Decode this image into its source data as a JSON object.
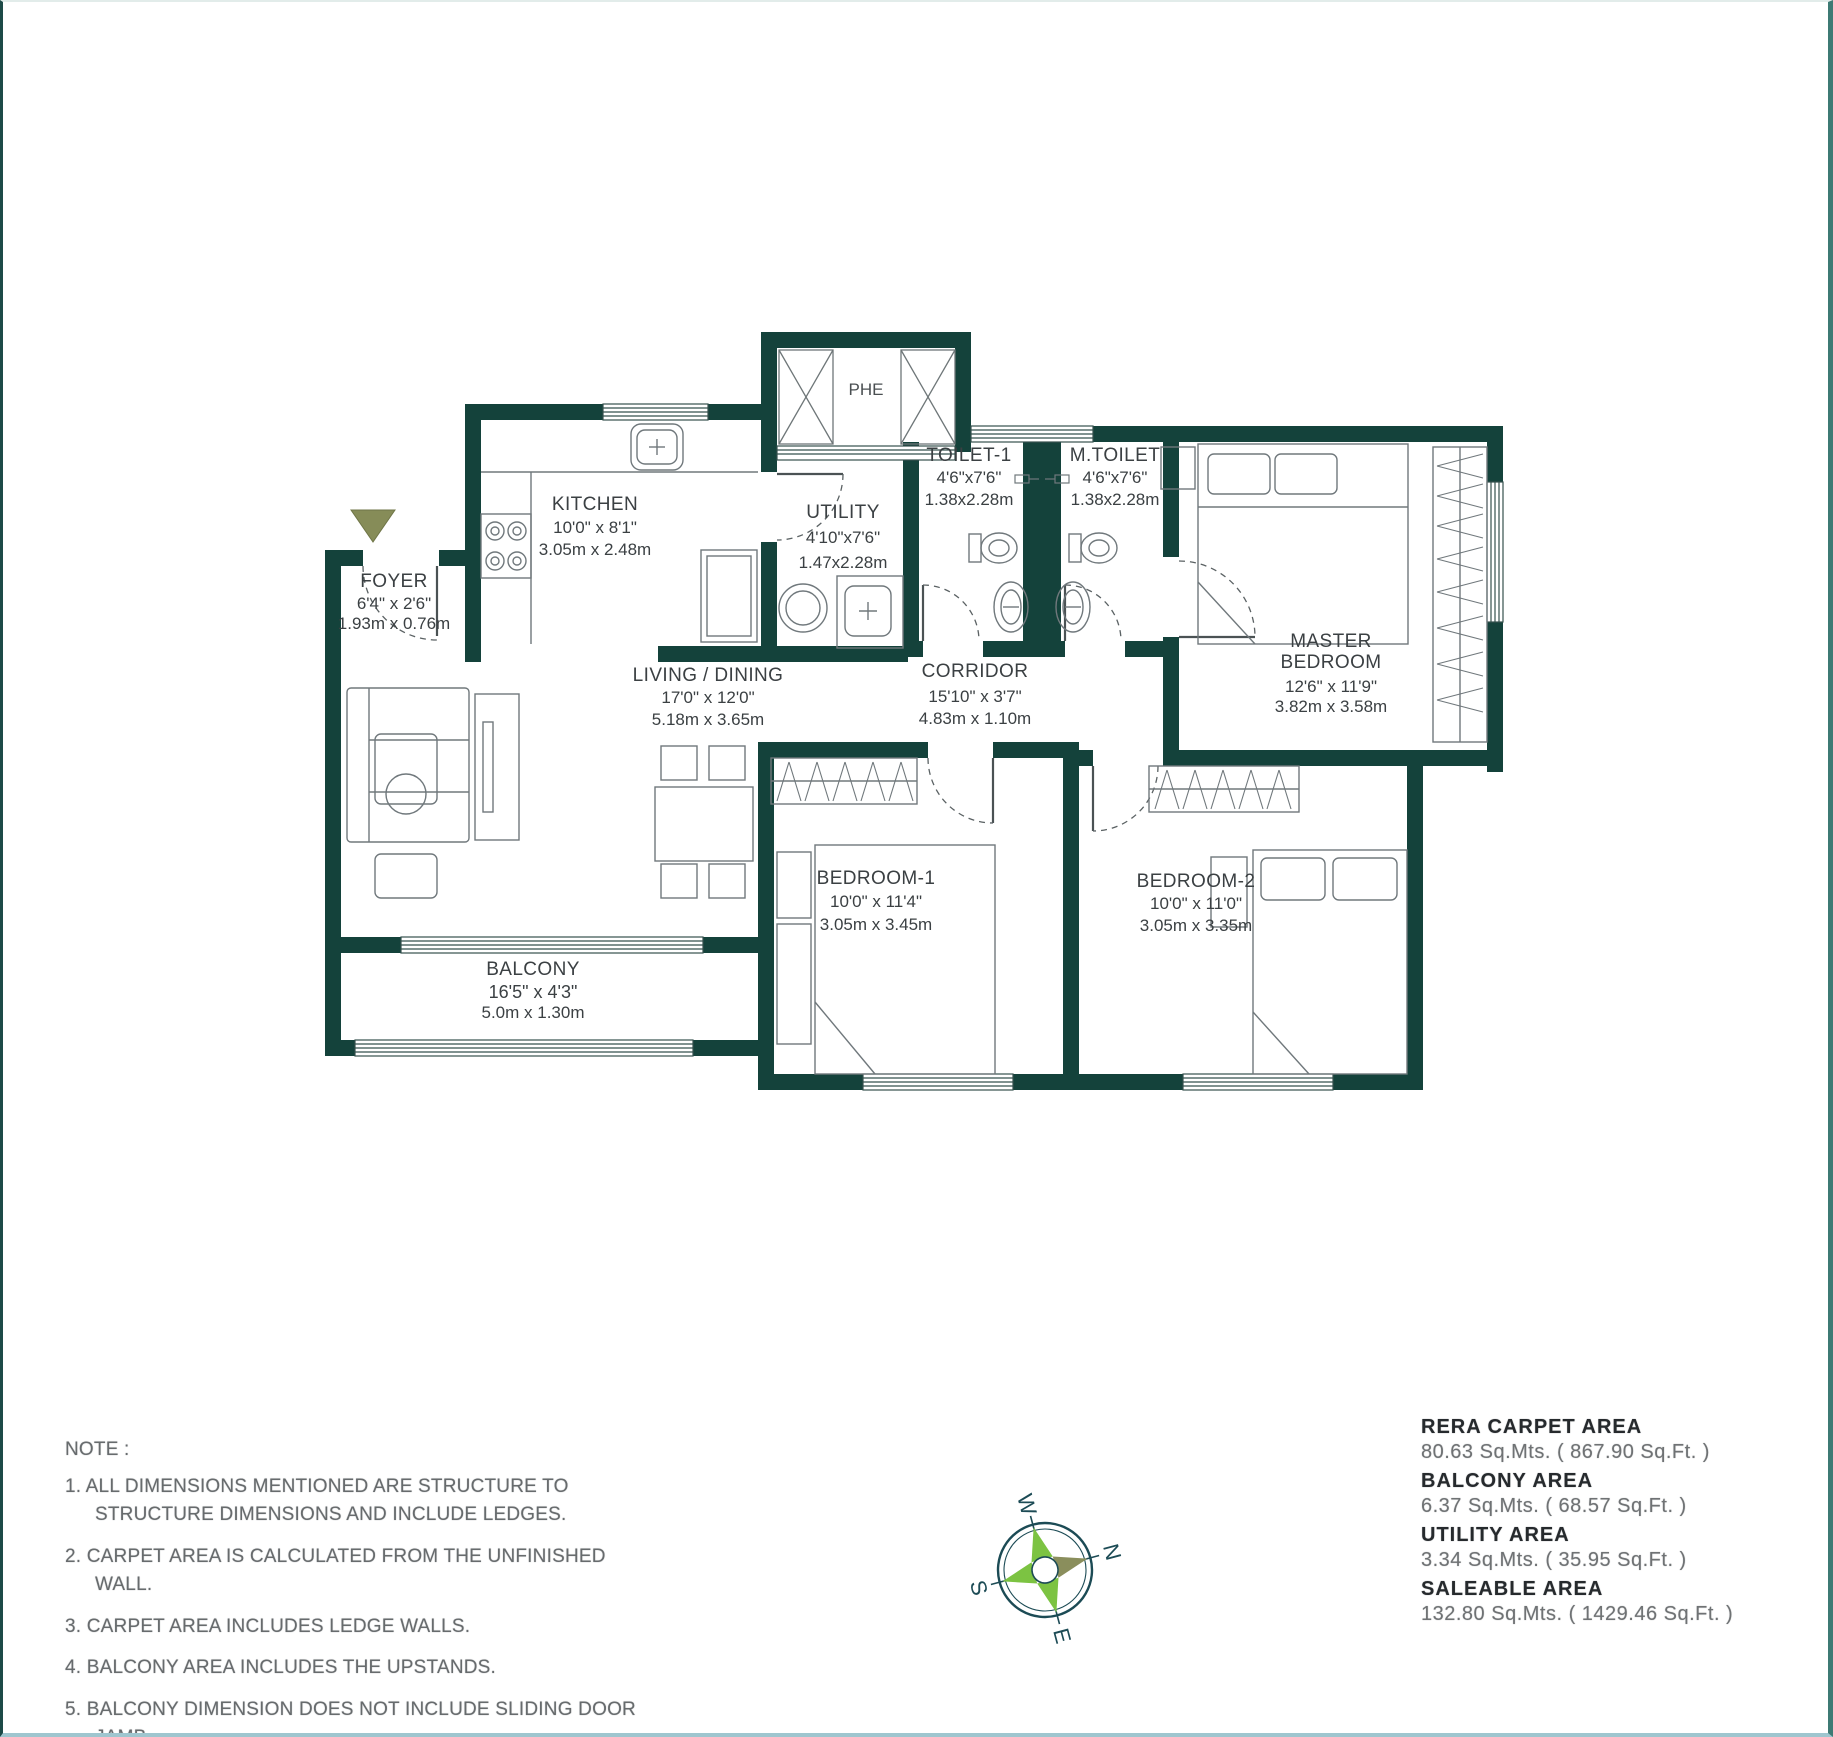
{
  "plan": {
    "shaft_label": "PHE",
    "rooms": [
      {
        "name": "FOYER",
        "dim_ft": "6'4\" x 2'6\"",
        "dim_m": "1.93m x 0.76m"
      },
      {
        "name": "KITCHEN",
        "dim_ft": "10'0\" x 8'1\"",
        "dim_m": "3.05m x 2.48m"
      },
      {
        "name": "UTILITY",
        "dim_ft": "4'10\"x7'6\"",
        "dim_m": "1.47x2.28m"
      },
      {
        "name": "TOILET-1",
        "dim_ft": "4'6\"x7'6\"",
        "dim_m": "1.38x2.28m"
      },
      {
        "name": "M.TOILET",
        "dim_ft": "4'6\"x7'6\"",
        "dim_m": "1.38x2.28m"
      },
      {
        "name_line1": "MASTER",
        "name_line2": "BEDROOM",
        "dim_ft": "12'6\" x 11'9\"",
        "dim_m": "3.82m x 3.58m"
      },
      {
        "name": "LIVING / DINING",
        "dim_ft": "17'0\" x 12'0\"",
        "dim_m": "5.18m x 3.65m"
      },
      {
        "name": "CORRIDOR",
        "dim_ft": "15'10\" x 3'7\"",
        "dim_m": "4.83m x 1.10m"
      },
      {
        "name": "BEDROOM-1",
        "dim_ft": "10'0\" x 11'4\"",
        "dim_m": "3.05m x 3.45m"
      },
      {
        "name": "BEDROOM-2",
        "dim_ft": "10'0\" x 11'0\"",
        "dim_m": "3.05m x 3.35m"
      },
      {
        "name": "BALCONY",
        "dim_ft": "16'5\" x 4'3\"",
        "dim_m": "5.0m x 1.30m"
      }
    ]
  },
  "notes": {
    "title": "NOTE :",
    "items": [
      "1.  ALL DIMENSIONS MENTIONED ARE STRUCTURE TO STRUCTURE DIMENSIONS AND INCLUDE LEDGES.",
      "2.  CARPET AREA IS CALCULATED FROM THE UNFINISHED WALL.",
      "3.  CARPET AREA INCLUDES LEDGE WALLS.",
      "4.  BALCONY AREA INCLUDES THE UPSTANDS.",
      "5.  BALCONY DIMENSION DOES NOT INCLUDE SLIDING DOOR JAMB"
    ]
  },
  "areas": {
    "rows": [
      {
        "label": "RERA CARPET AREA",
        "value": "80.63 Sq.Mts. ( 867.90 Sq.Ft. )"
      },
      {
        "label": "BALCONY AREA",
        "value": "6.37 Sq.Mts. ( 68.57 Sq.Ft. )"
      },
      {
        "label": "UTILITY AREA",
        "value": "3.34 Sq.Mts. ( 35.95 Sq.Ft. )"
      },
      {
        "label": "SALEABLE AREA",
        "value": "132.80 Sq.Mts. ( 1429.46 Sq.Ft. )"
      }
    ]
  },
  "compass": {
    "north": "N",
    "east": "E",
    "south": "S",
    "west": "W"
  },
  "colors": {
    "wall": "#14423b",
    "accent_green": "#7cc342",
    "accent_olive": "#8a8e5c"
  }
}
